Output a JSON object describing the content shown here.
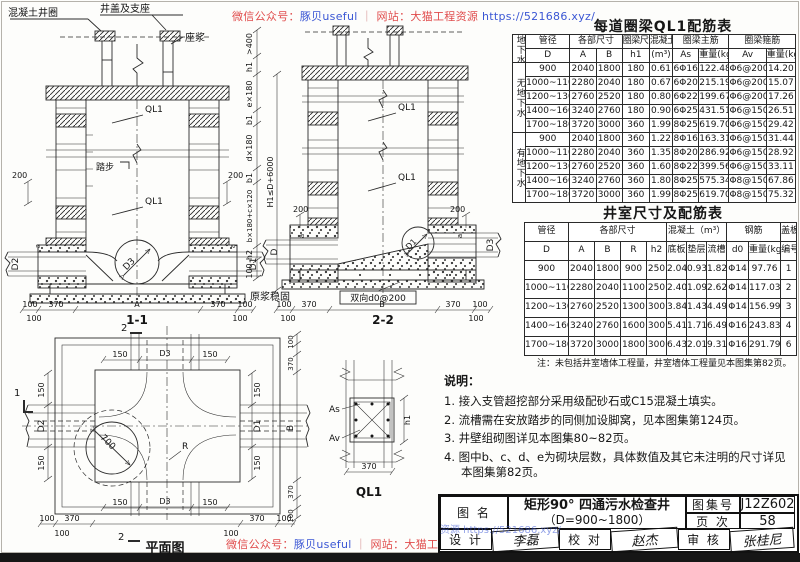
{
  "watermark": {
    "wechat_label": "微信公众号：",
    "wechat_name": "豚贝useful",
    "separator": "｜",
    "site_label": "网站：",
    "site_name": "大猫工程资源",
    "url": "https://521686.xyz/",
    "mid_fragment": "资源 https://521686.xyz/"
  },
  "dwg": {
    "t11": "1-1",
    "t22": "2-2",
    "tplan": "平面图",
    "tql1": "QL1",
    "concrete_ring": "混凝土井圈",
    "cover": "井盖及支座",
    "mortar": "座浆",
    "steps": "踏步",
    "ql1": "QL1",
    "d": "D",
    "d1": "D1",
    "d2": "D2",
    "d3": "D3",
    "grout": "原浆稳固",
    "biaxial": "双向d0@200",
    "as": "As",
    "av": "Av",
    "h1": "h1",
    "h2": "h2",
    "b1": "b1",
    "a": "a",
    "gt400": ">400",
    "e180": "e×180",
    "d180": "d×180",
    "bc": "b×180+c×120",
    "H1": "H1≤D+6000",
    "A": "A",
    "B": "B",
    "R": "R",
    "n100": "100",
    "n150": "150",
    "n200": "200",
    "n370": "370",
    "n700": "700",
    "m1": "1",
    "m2": "2"
  },
  "table1": {
    "title": "每道圈梁QL1配筋表",
    "headers": {
      "gw": "地下水",
      "pipe": "管径",
      "dims": "各部尺寸",
      "beam": "圈梁尺寸",
      "conc": "混凝土",
      "main": "圈梁主筋",
      "stir": "圈梁箍筋",
      "d": "D",
      "a": "A",
      "b": "B",
      "h1": "h1",
      "m3": "(m³)",
      "as": "As",
      "wt": "重量(kg)",
      "av": "Av"
    },
    "rows": [
      [
        {
          "t": "无地下水",
          "rs": 5,
          "cls": "vert"
        },
        "900",
        "2040",
        "1800",
        "180",
        "0.61",
        "6Φ16",
        "122.48",
        "Φ6@200",
        "14.20"
      ],
      [
        "1000~1100",
        "2280",
        "2040",
        "180",
        "0.67",
        "6Φ20",
        "215.19",
        "Φ6@200",
        "15.07"
      ],
      [
        "1200~1300",
        "2760",
        "2520",
        "180",
        "0.80",
        "6Φ22",
        "199.67",
        "Φ6@200",
        "17.26"
      ],
      [
        "1400~1600",
        "3240",
        "2760",
        "180",
        "0.90",
        "6Φ25",
        "431.51",
        "Φ6@150",
        "26.51"
      ],
      [
        "1700~1800",
        "3720",
        "3000",
        "360",
        "1.99",
        "8Φ25",
        "619.70",
        "Φ6@150",
        "29.42"
      ],
      [
        {
          "t": "有地下水",
          "rs": 5,
          "cls": "vert"
        },
        "900",
        "2040",
        "1800",
        "360",
        "1.22",
        "8Φ16",
        "163.31",
        "Φ6@150",
        "31.44"
      ],
      [
        "1000~1100",
        "2280",
        "2040",
        "360",
        "1.35",
        "8Φ20",
        "286.92",
        "Φ6@150",
        "28.92"
      ],
      [
        "1200~1300",
        "2760",
        "2520",
        "360",
        "1.60",
        "8Φ22",
        "399.56",
        "Φ6@150",
        "33.11"
      ],
      [
        "1400~1600",
        "3240",
        "2760",
        "360",
        "1.80",
        "8Φ25",
        "575.34",
        "Φ8@150",
        "67.86"
      ],
      [
        "1700~1800",
        "3720",
        "3000",
        "360",
        "1.99",
        "8Φ25",
        "619.70",
        "Φ8@150",
        "75.32"
      ]
    ]
  },
  "table2": {
    "title": "井室尺寸及配筋表",
    "headers": {
      "pipe": "管径",
      "dims": "各部尺寸",
      "conc": "混凝土（m³）",
      "steel": "钢筋",
      "cover": "盖板",
      "d": "D",
      "a": "A",
      "b": "B",
      "r": "R",
      "h2": "h2",
      "base": "底板",
      "cushion": "垫层",
      "channel": "流槽",
      "d0": "d0",
      "wt": "重量(kg)",
      "no": "编号"
    },
    "rows": [
      [
        "900",
        "2040",
        "1800",
        "900",
        "250",
        "2.04",
        "0.93",
        "1.82",
        "Φ14",
        "97.76",
        "1"
      ],
      [
        "1000~1100",
        "2280",
        "2040",
        "1100",
        "250",
        "2.40",
        "1.09",
        "2.62",
        "Φ14",
        "117.03",
        "2"
      ],
      [
        "1200~1300",
        "2760",
        "2520",
        "1300",
        "300",
        "3.84",
        "1.43",
        "4.49",
        "Φ14",
        "156.99",
        "3"
      ],
      [
        "1400~1600",
        "3240",
        "2760",
        "1600",
        "300",
        "5.41",
        "1.71",
        "6.49",
        "Φ16",
        "243.83",
        "4"
      ],
      [
        "1700~1800",
        "3720",
        "3000",
        "1800",
        "300",
        "6.43",
        "2.01",
        "9.31",
        "Φ16",
        "291.79",
        "6"
      ]
    ],
    "note": "注：未包括井室墙体工程量，井室墙体工程量见本图集第82页。"
  },
  "notes": {
    "title": "说明：",
    "items": [
      "1.  接入支管超挖部分采用级配砂石或C15混凝土填实。",
      "2.  流槽需在安放踏步的同侧加设脚窝，见本图集第124页。",
      "3.  井壁组砌图详见本图集80~82页。",
      "4.  图中b、c、d、e为砌块层数，具体数值及其它未注明的尺寸详见本图集第82页。"
    ]
  },
  "titleblock": {
    "name_label": "图 名",
    "name_line1": "矩形90° 四通污水检查井",
    "name_line2": "（D=900~1800）",
    "atlas_label": "图集号",
    "atlas_no": "J12Z602",
    "page_label": "页 次",
    "page_no": "58",
    "design_label": "设 计",
    "design_sig": "李磊",
    "check_label": "校 对",
    "check_sig": "赵杰",
    "review_label": "审 核",
    "review_sig": "张桂尼"
  }
}
